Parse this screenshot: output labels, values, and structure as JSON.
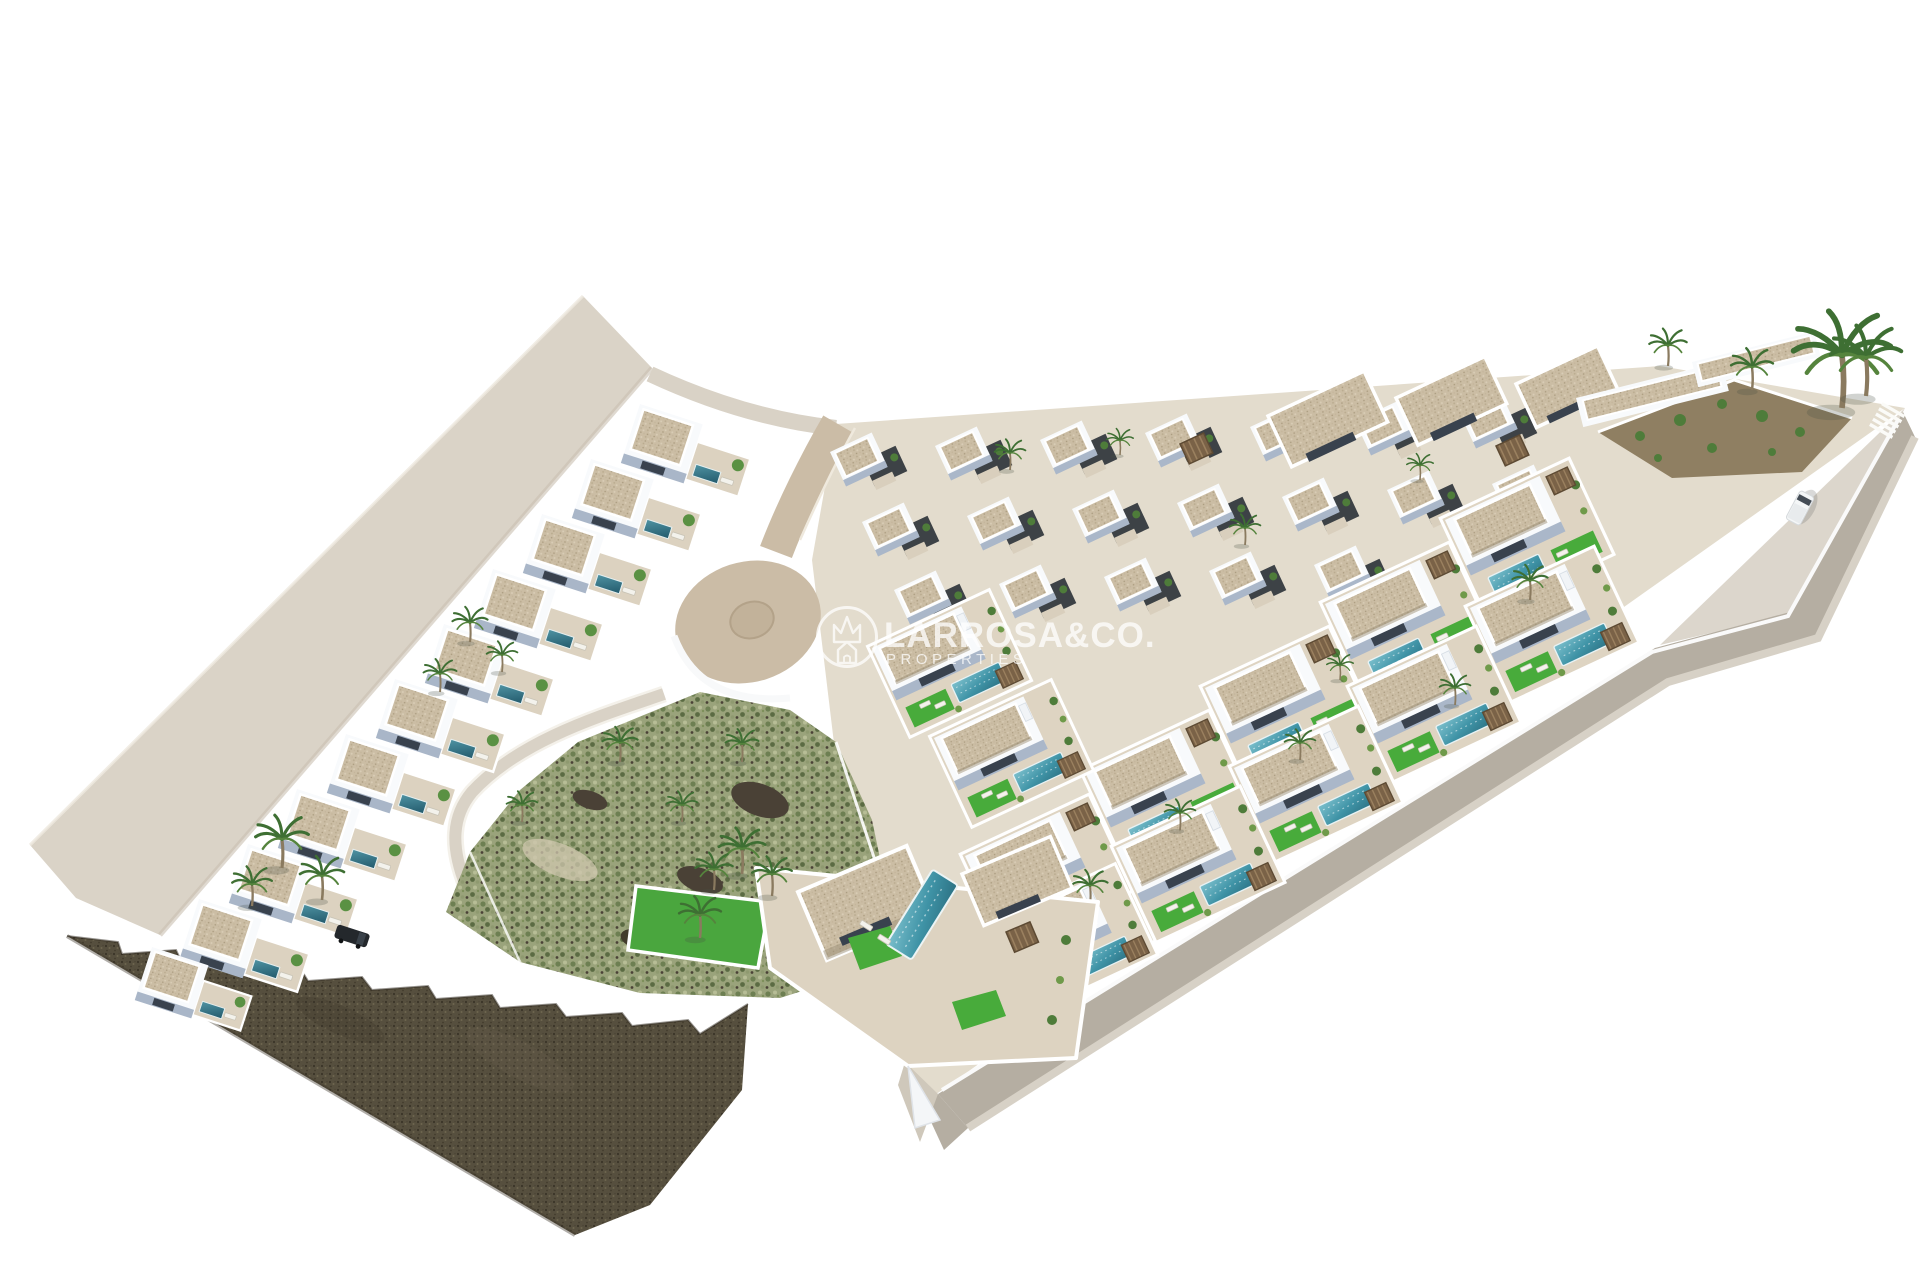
{
  "image": {
    "description": "Aerial 3D architectural render of a Mediterranean residential development of white villas with private pools, palm trees, roads and an undeveloped green plot, isolated on a white background",
    "style": "photorealistic 3D site-plan render",
    "background_color": "#ffffff"
  },
  "watermark": {
    "brand": "LARROSA&CO.",
    "tagline": "PROPERTIES",
    "logo": "crown-over-house-in-circle-icon",
    "text_color": "#ffffff",
    "opacity": 0.75
  },
  "scene": {
    "colors": {
      "pavement_light": "#d9d2c6",
      "access_road_tan": "#cbbca6",
      "perimeter_road_grey": "#b5aea2",
      "villa_white": "#f8fafc",
      "villa_shadow_blue": "#aab7c9",
      "roof_gravel_tan": "#cbbda4",
      "garden_charcoal": "#3d4246",
      "lawn_green": "#48ab3b",
      "scrubland_olive": "#9aa37b",
      "pool_teal": "#3f93a6",
      "palm_green": "#3e6f33",
      "rock_wall_brown": "#564f3e",
      "terrace_beige": "#ded4c2"
    },
    "features": [
      "stepped row of terraced villas along the north-west road",
      "clustered villas with gravel roof terraces in the centre and east",
      "private pools with sun loungers and artificial lawns",
      "looping cul-de-sac access road",
      "undeveloped green scrubland plot in the centre",
      "dark stone cut-away embankment at the south-west corner",
      "perimeter road with zebra crossing and one white van",
      "dark SUV parked beside the lower villas",
      "tall palm tree at the eastern tip of the plot"
    ]
  }
}
